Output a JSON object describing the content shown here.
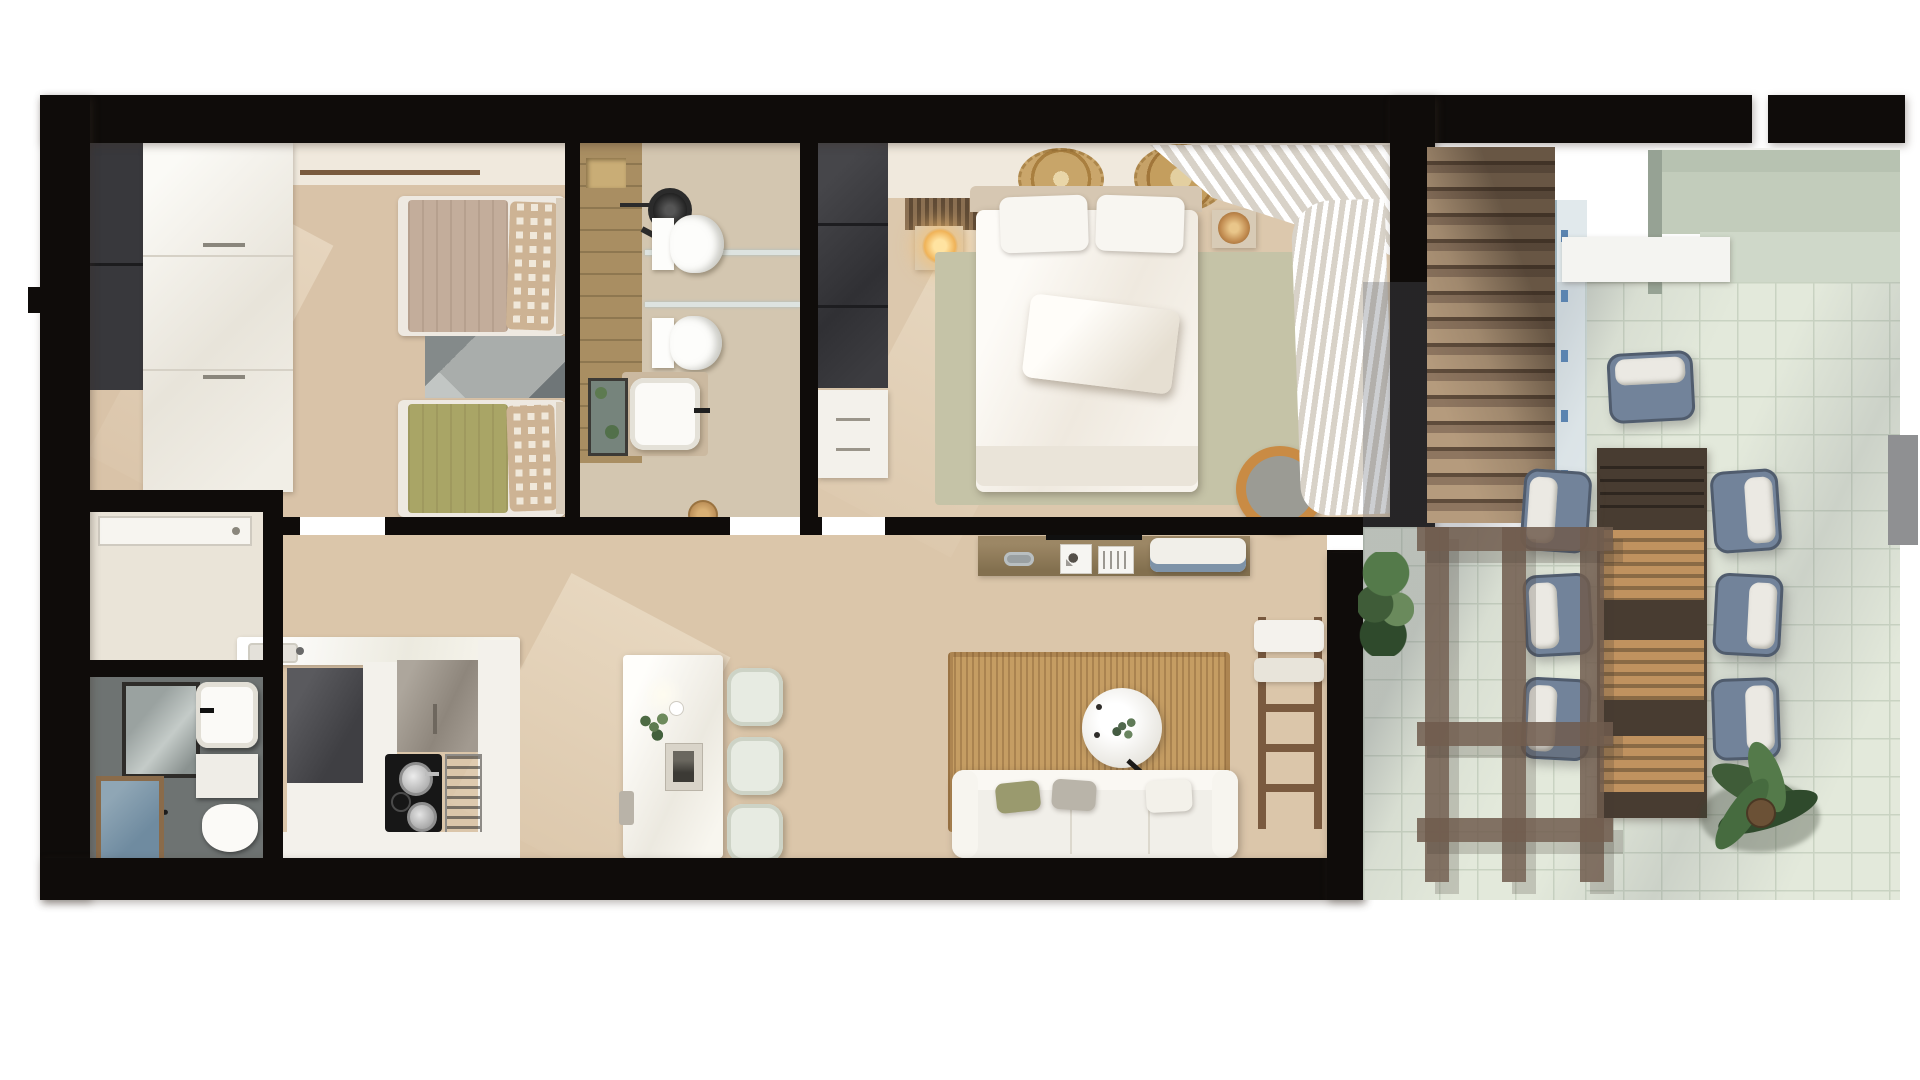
{
  "scene": {
    "type": "apartment-floor-plan-top-down-3d-render",
    "background": "#ffffff",
    "no_visible_text": true
  },
  "palette": {
    "wall": "#0f0c0a",
    "floorBeige": "#d9c3a8",
    "floorMaster": "#dcc8ad",
    "floorLiving": "#dbc6aa",
    "floorEntry": "#eae4d8",
    "floorBath2": "#6e7372",
    "floorBath1": "#d3c6b0",
    "tanTile": "#a98e62",
    "whiteFurn": "#f3f1eb",
    "taupe": "#9b9389",
    "fridge": "#4e4e50",
    "darkCab": "#38383c",
    "sage": "#c5c3a7",
    "oliveBed": "#a9a566",
    "taupeBed": "#c3ad9b",
    "gingA": "#cdb394",
    "gingB": "#f0e8da",
    "rugGray": "#a9adab",
    "jute": "#c59d63",
    "wood": "#8f7a5a",
    "ladder": "#7a5a3f",
    "slatLight": "#b59b7d",
    "slatDark": "#5f4c3b",
    "glass": "#c7d6db",
    "terrTile": "#e3e9db",
    "terrGrid": "#c9d3c2",
    "pergola": "#705c4e",
    "tableDark": "#483c31",
    "tableLight": "#c0925f",
    "chairBlue": "#72839a",
    "chairPillow": "#ebe9e3",
    "sageWall": "#b7c2b1",
    "plant": "#3f5c38",
    "pouf": "#c98b44",
    "glow": "#f7c775",
    "curtain": "#d8d2c8",
    "ceil": "#f0e9dd"
  },
  "plan": {
    "rooms": [
      {
        "id": "bedroom-twin",
        "label": "twin bedroom",
        "items": [
          "dark-wardrobe",
          "white-wardrobe",
          "twin-bed-taupe",
          "twin-bed-olive",
          "gingham-pillows",
          "geometric-rug",
          "curtain-rail"
        ]
      },
      {
        "id": "bathroom-main",
        "label": "main bathroom",
        "items": [
          "tan-tile-wall",
          "walk-in-shower",
          "shower-head",
          "toilet",
          "bidet",
          "glass-shelves",
          "vanity-mirror",
          "vanity-sink",
          "basket"
        ]
      },
      {
        "id": "bedroom-master",
        "label": "master bedroom",
        "items": [
          "dark-wardrobe",
          "white-dresser",
          "slatted-headboard-panel",
          "nightstand-left",
          "glowing-lamp",
          "nightstand-right",
          "rattan-lamp",
          "juju-wall-decor-1",
          "juju-wall-decor-2",
          "double-bed",
          "pillows",
          "sage-rug",
          "pouf",
          "window-curtains"
        ]
      },
      {
        "id": "entry-hall",
        "label": "entry hall",
        "items": [
          "entrance-door"
        ]
      },
      {
        "id": "bathroom-second",
        "label": "shower room",
        "items": [
          "framed-mirror",
          "blue-glass-shower-screen",
          "vanity-sink",
          "vanity-cabinet",
          "toilet",
          "towel-rail"
        ]
      },
      {
        "id": "kitchen",
        "label": "kitchen",
        "items": [
          "peninsula-counter",
          "counter-sink",
          "fridge",
          "tall-white-cabinet",
          "taupe-wall-cabinet",
          "induction-cooktop",
          "two-pots",
          "stainless-oven-column",
          "base-counter",
          "island-breakfast-bar",
          "island-plant",
          "island-tray",
          "bar-stool-1",
          "bar-stool-2",
          "bar-stool-3"
        ]
      },
      {
        "id": "living-dining",
        "label": "living room",
        "items": [
          "tv-console",
          "tv",
          "decor-dish",
          "art-frame-1",
          "art-frame-2",
          "stacked-cushions",
          "jute-rug",
          "round-coffee-table",
          "table-plant",
          "arc-floor-lamp",
          "sofa",
          "sofa-pillows",
          "blanket-ladder",
          "ladder-towels"
        ]
      },
      {
        "id": "terrace",
        "label": "terrace",
        "items": [
          "louvered-deck",
          "glass-balustrade",
          "white-canopy",
          "neighbour-parapet-walls",
          "tiled-pool-deck",
          "pergola-grid",
          "outdoor-dining-table",
          "dining-chair-head",
          "dining-chairs-left-3",
          "dining-chairs-right-3",
          "corner-plant",
          "large-plant",
          "gray-column"
        ]
      }
    ]
  }
}
